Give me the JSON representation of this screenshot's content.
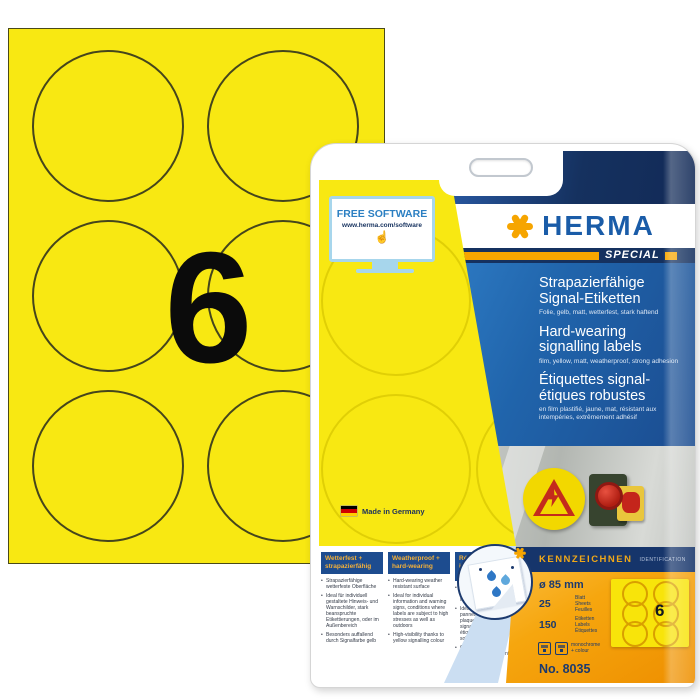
{
  "sheet": {
    "big_count": "6"
  },
  "package": {
    "software": {
      "title": "FREE SOFTWARE",
      "url": "www.herma.com/software"
    },
    "brand": "HERMA",
    "series": "SPECIAL",
    "lang_blocks": {
      "de": {
        "line1": "Strapazierfähige",
        "line2": "Signal-Etiketten",
        "sub": "Folie, gelb, matt, wetterfest, stark haftend"
      },
      "en": {
        "line1": "Hard-wearing",
        "line2": "signalling labels",
        "sub": "film, yellow, matt, weatherproof, strong adhesion"
      },
      "fr": {
        "line1": "Étiquettes signal-",
        "line2": "étiques robustes",
        "sub": "en film plastifié, jaune, mat, résistant aux intempéries, extrêmement adhésif"
      }
    },
    "made_in": "Made in Germany",
    "category": {
      "de": "KENNZEICHNEN",
      "en": "IDENTIFICATION"
    },
    "features": {
      "de": {
        "header": "Wetterfest + strapazierfähig",
        "bullets": [
          "Strapazierfähige wetterfeste Oberfläche",
          "Ideal für individuell gestaltete Hinweis- und Warnschilder, stark beanspruchte Etikettierungen, oder im Außenbereich",
          "Besonders auffallend durch Signalfarbe gelb"
        ]
      },
      "en": {
        "header": "Weatherproof + hard-wearing",
        "bullets": [
          "Hard-wearing weather resistant surface",
          "Ideal for individual information and warning signs, conditions where labels are subject to high stresses as well as outdoors",
          "High-visibility thanks to yellow signalling colour"
        ]
      },
      "fr": {
        "header": "Résistant aux intem- péries + robustes",
        "bullets": [
          "Surface robuste et résistante aux intempéries",
          "Idéales pour les panneaux individualisés, plaques indicatrices, signaux de danger, les étiquetages fortement sollicités et l'extérieur",
          "Couleur signalétique jaune particulièrement voyante"
        ]
      }
    },
    "specs": {
      "diameter": "ø 85 mm",
      "sheets_value": "25",
      "sheets_units": [
        "Blatt",
        "Sheets",
        "Feuilles"
      ],
      "labels_value": "150",
      "labels_units": [
        "Etiketten",
        "Labels",
        "Étiquettes"
      ],
      "print_note_1": "monochrome",
      "print_note_2": "+ colour",
      "number": "No. 8035",
      "thumb_count": "6"
    },
    "colors": {
      "label_yellow": "#F8E812",
      "brand_blue": "#1A5CA8",
      "navy": "#15315F",
      "accent_orange": "#F6A500",
      "panel_orange": "#F6A60E"
    }
  }
}
